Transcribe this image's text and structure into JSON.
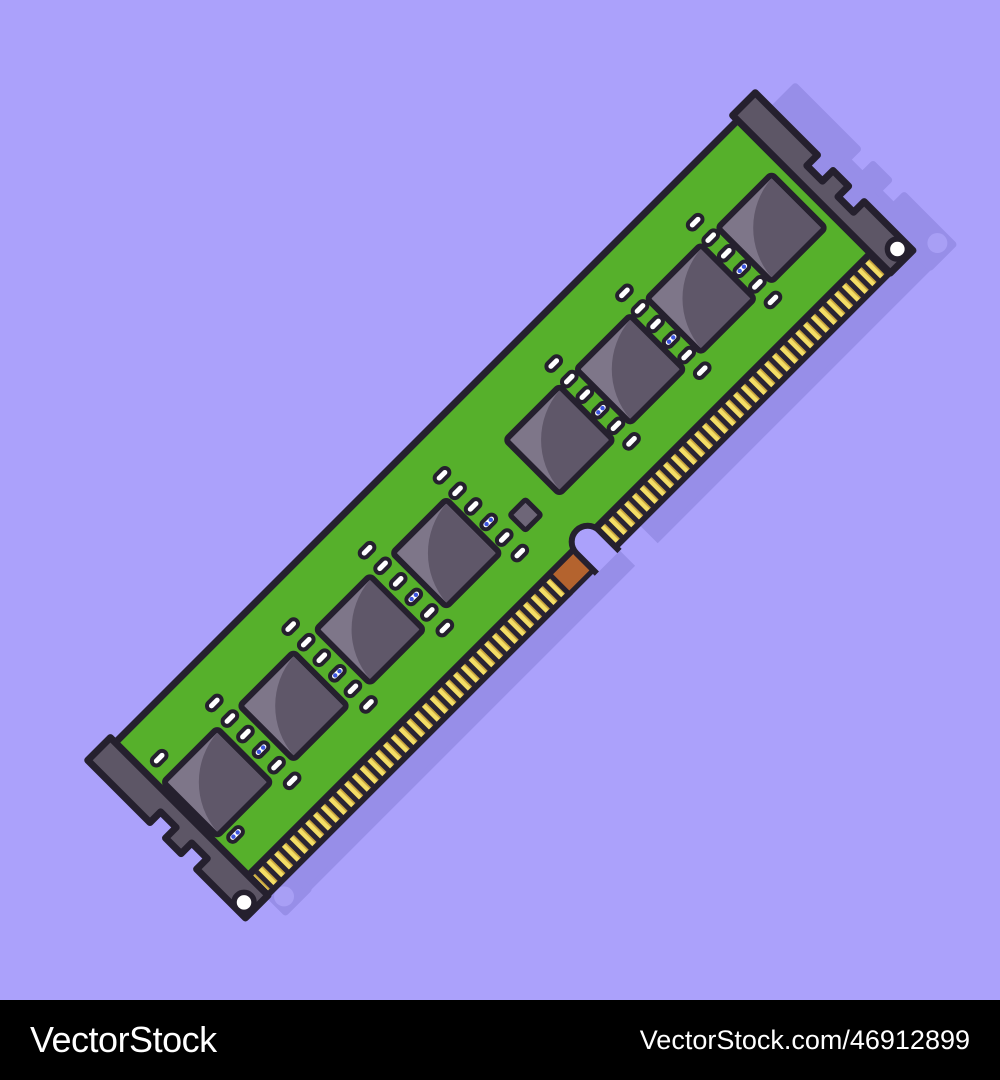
{
  "watermark": {
    "brand": "VectorStock",
    "url_text": "VectorStock.com/46912899"
  },
  "illustration": {
    "subject_chip_count": 8,
    "colors": {
      "bg": "#aba1fb",
      "shadow": "#978ee8",
      "shadow_hole": "#a89ff5",
      "outline": "#25202e",
      "pcb": "#56b02b",
      "cap": "#5d5666",
      "chip_light": "#7e7689",
      "chip_dark": "#5f5769",
      "smd": "#6e6678",
      "band": "#2a2433",
      "gold": "#f4de66",
      "gold_dark": "#c9a53c",
      "copper": "#b4632e",
      "pad": "#ffffff",
      "pad_dot": "#3d55e0",
      "bar_bg": "#000000",
      "bar_text": "#ffffff"
    }
  }
}
